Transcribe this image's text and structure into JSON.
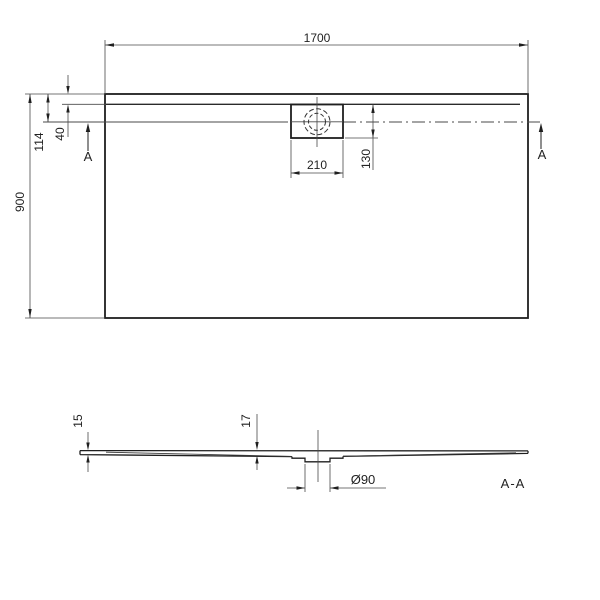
{
  "plan": {
    "width_label": "1700",
    "depth_label": "900",
    "drain_offset_label": "114",
    "rim_inset_label": "40",
    "drain_box_width_label": "210",
    "drain_box_height_label": "130",
    "section_marker_left": "A",
    "section_marker_right": "A"
  },
  "section": {
    "title": "A-A",
    "edge_thickness_label": "15",
    "mid_thickness_label": "17",
    "drain_diameter_label": "Ø90"
  },
  "colors": {
    "outline": "#1f1f1f",
    "thin_line": "#4a4a4a",
    "text": "#222222"
  }
}
